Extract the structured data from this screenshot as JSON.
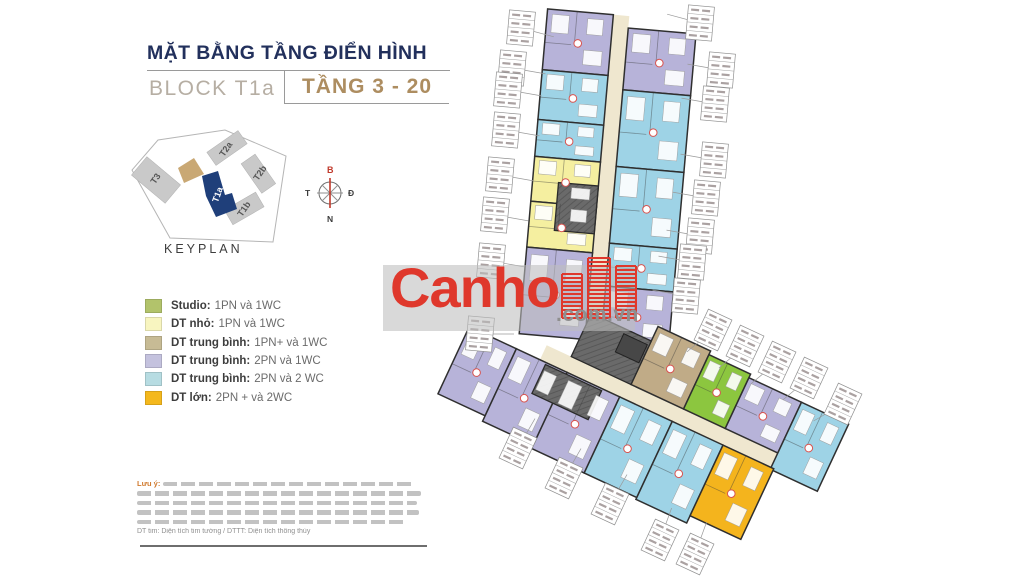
{
  "header": {
    "title": "MẶT BẰNG TẦNG ĐIỂN HÌNH",
    "block_label": "BLOCK T1a",
    "floor_label": "TẦNG 3 - 20"
  },
  "keyplan": {
    "caption": "KEYPLAN",
    "blocks": {
      "t3": "T3",
      "t2a": "T2a",
      "t2b": "T2b",
      "t1b": "T1b",
      "t1a": "T1a"
    }
  },
  "compass": {
    "north": "B",
    "east": "Đ",
    "south": "N",
    "west": "T"
  },
  "legend": {
    "items": [
      {
        "label": "Studio:",
        "desc": "1PN và 1WC",
        "color": "#b2c36b"
      },
      {
        "label": "DT nhỏ:",
        "desc": "1PN và 1WC",
        "color": "#f8f5c0"
      },
      {
        "label": "DT trung bình:",
        "desc": "1PN+ và 1WC",
        "color": "#c7bb95"
      },
      {
        "label": "DT trung bình:",
        "desc": "2PN và 1WC",
        "color": "#c4c2de"
      },
      {
        "label": "DT trung bình:",
        "desc": "2PN và 2 WC",
        "color": "#b7dce2"
      },
      {
        "label": "DT lớn:",
        "desc": "2PN + và 2WC",
        "color": "#f4b81d"
      }
    ]
  },
  "watermark": {
    "brand": "Canho",
    "suffix": ".com.vn",
    "brand_color": "#df382c"
  },
  "disclaimer": {
    "label": "Lưu ý:",
    "abbrev_note": "DT tim: Diện tích tim tường / DTTT: Diện tích thông thủy"
  },
  "plan": {
    "colors": {
      "studio": "#8cc63f",
      "small": "#f5efa0",
      "medium_1pn": "#c0ab87",
      "medium_2pn_1wc": "#b7b3d9",
      "medium_2pn_2wc": "#9ed3e6",
      "large": "#f4b41d"
    },
    "corridor_color": "#efe7cf",
    "core_color": "#6a6a6a",
    "wall_color": "#2f2f2f"
  }
}
